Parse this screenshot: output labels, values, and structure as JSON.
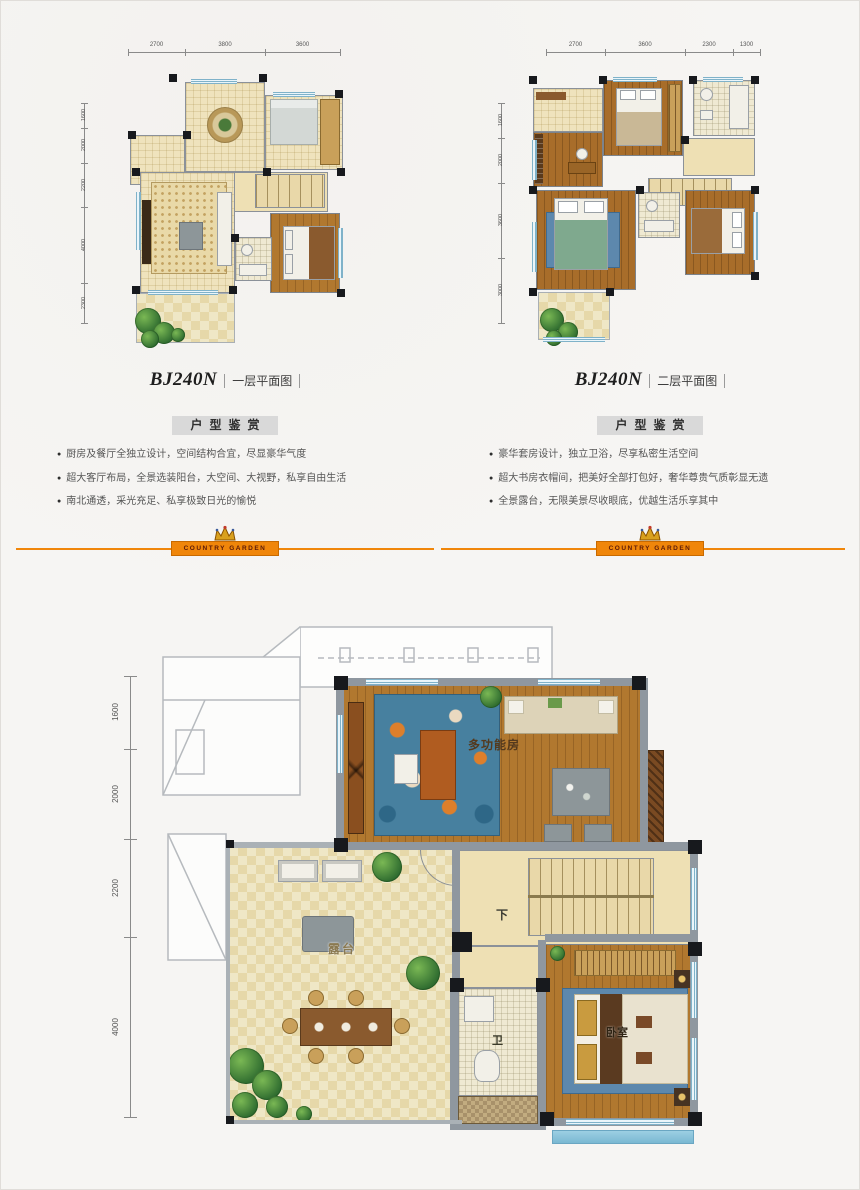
{
  "brand": {
    "name": "COUNTRY GARDEN"
  },
  "colors": {
    "accent_orange": "#f0860a",
    "badge_gray": "#d9d9d9"
  },
  "columns": [
    {
      "model": "BJ240N",
      "caption": "一层平面图",
      "badge": "户型鉴赏",
      "bullets": [
        "厨房及餐厅全独立设计，空间结构合宜，尽显豪华气度",
        "超大客厅布局，全景选装阳台，大空间、大视野，私享自由生活",
        "南北通透，采光充足、私享极致日光的愉悦"
      ],
      "dims_top": [
        "2700",
        "3800",
        "3600"
      ],
      "dims_left": [
        "1600",
        "2000",
        "2200",
        "4000",
        "2300"
      ]
    },
    {
      "model": "BJ240N",
      "caption": "二层平面图",
      "badge": "户型鉴赏",
      "bullets": [
        "豪华套房设计，独立卫浴，尽享私密生活空间",
        "超大书房衣帽间，把美好全部打包好，奢华尊贵气质彰显无遗",
        "全景露台，无限美景尽收眼底，优越生活乐享其中"
      ],
      "dims_top": [
        "2700",
        "3600",
        "2300",
        "1300"
      ],
      "dims_left": [
        "1600",
        "2000",
        "3600",
        "3000"
      ]
    }
  ],
  "floor3": {
    "dims_left": [
      "1600",
      "2000",
      "2200",
      "4000"
    ],
    "rooms": {
      "multi_function": "多功能房",
      "terrace": "露台",
      "bath": "卫",
      "bedroom": "卧室",
      "stairs_down": "下"
    }
  }
}
